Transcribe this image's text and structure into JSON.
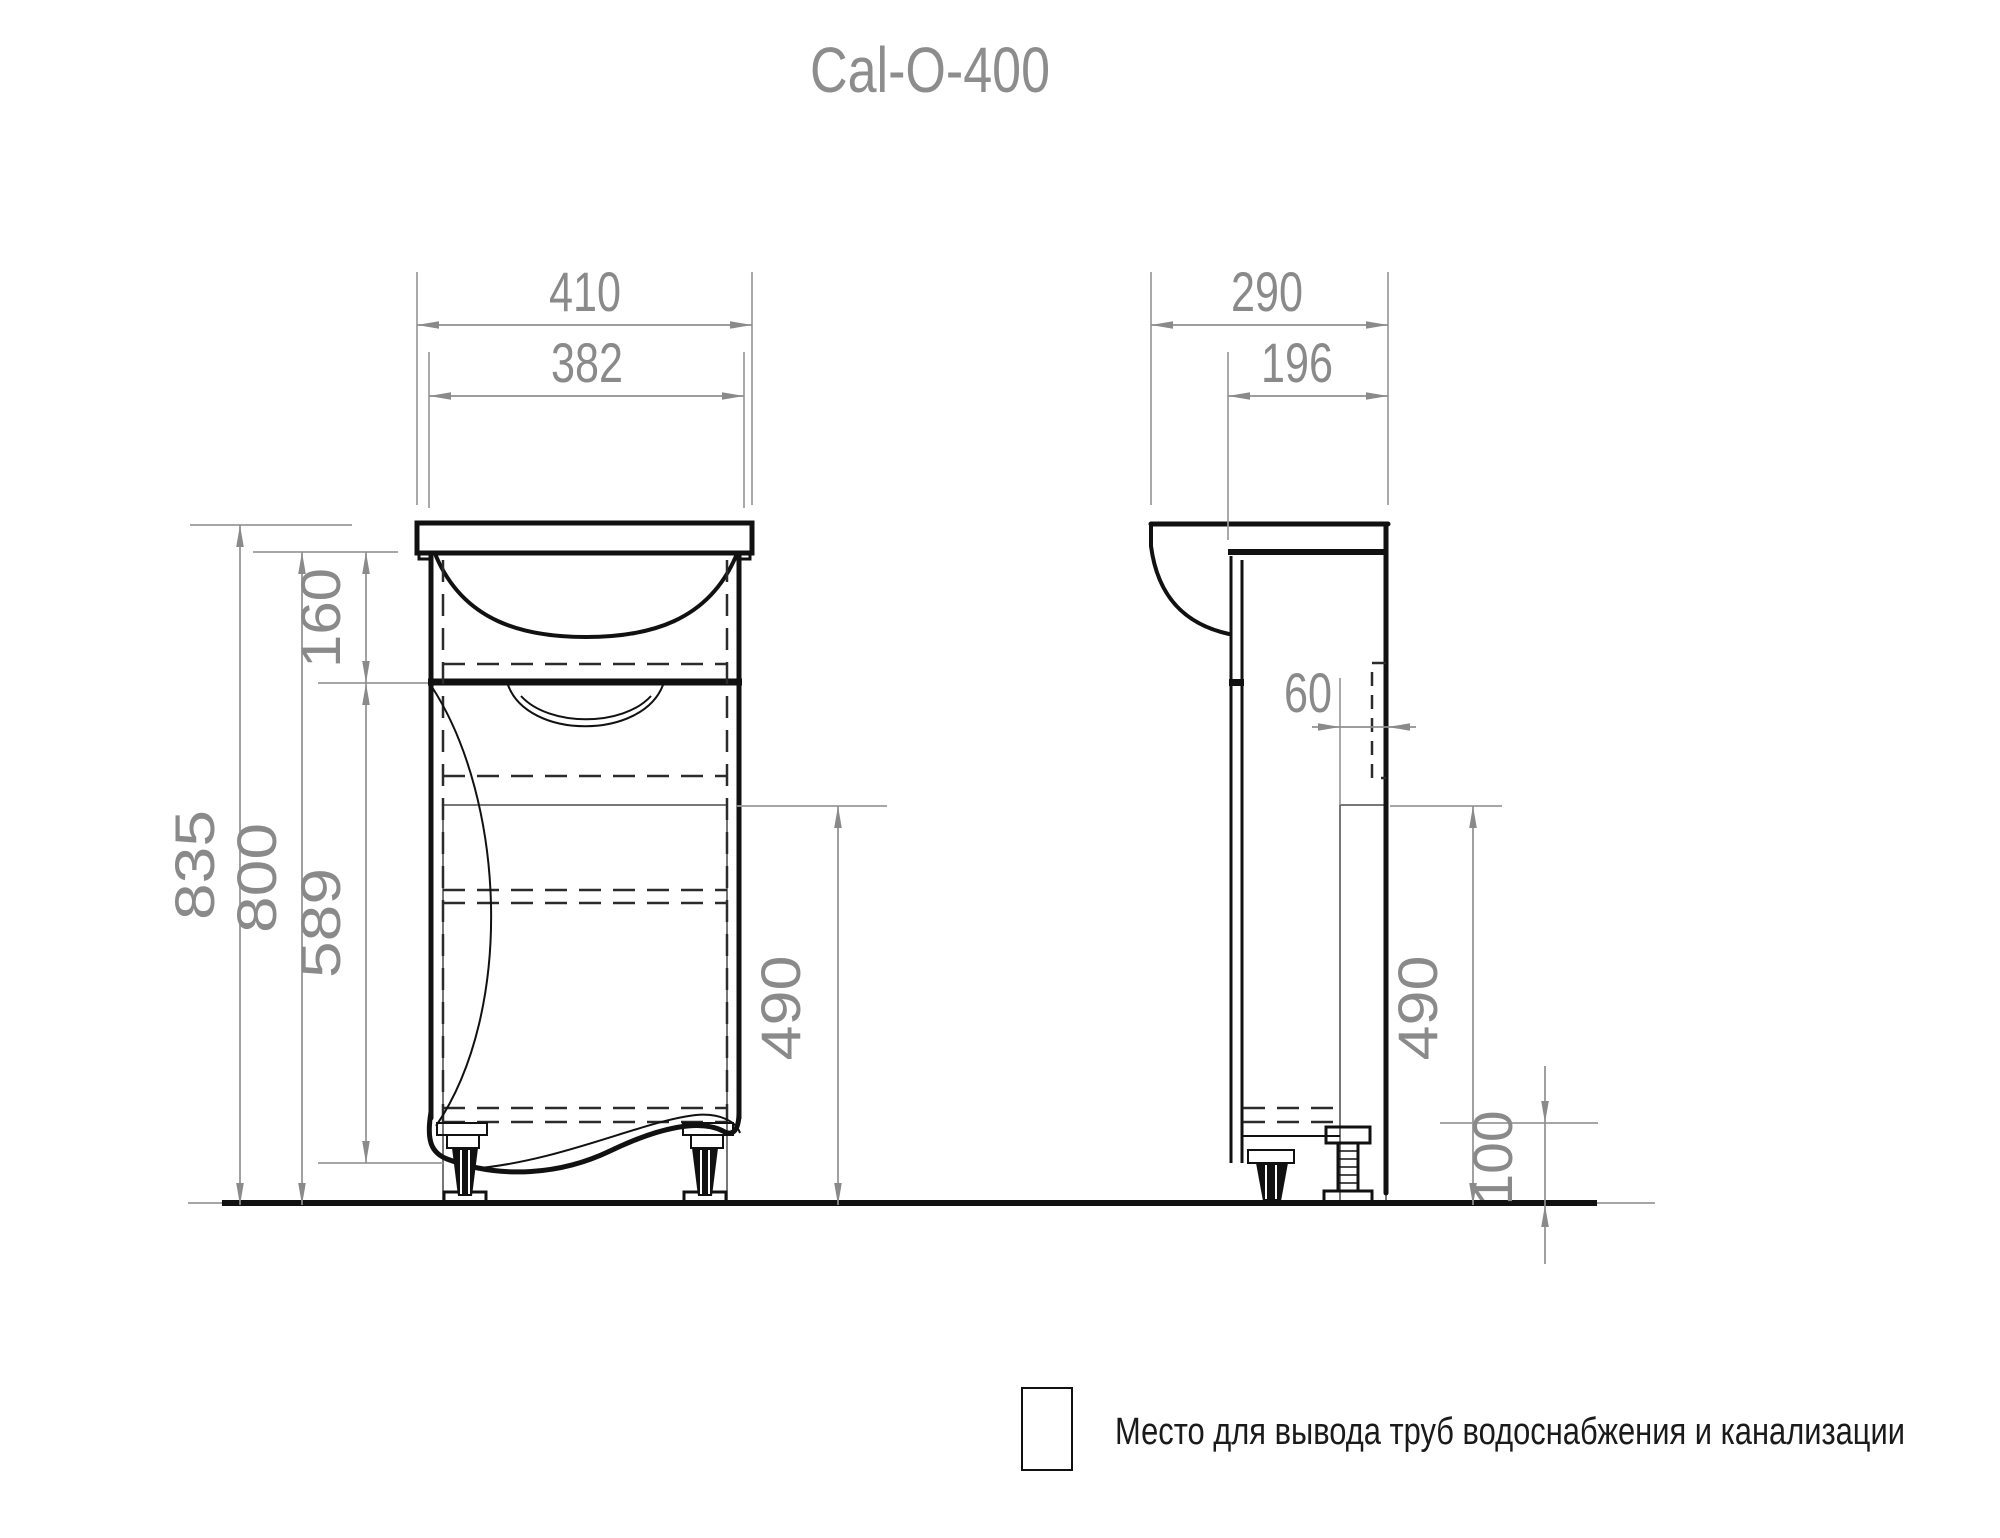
{
  "title": "Cal-O-400",
  "front_view": {
    "overall_width": "410",
    "basin_width": "382",
    "overall_height": "835",
    "cabinet_height": "800",
    "top_section_height": "160",
    "door_height": "589",
    "pipe_zone_height": "490"
  },
  "side_view": {
    "overall_depth": "290",
    "cabinet_depth": "196",
    "pipe_zone_depth": "60",
    "pipe_zone_height": "490",
    "plinth_height": "100"
  },
  "legend": {
    "swatch": "diagonal-hatch",
    "text": "Место для вывода труб водоснабжения и канализации"
  },
  "colors": {
    "line": "#111111",
    "dimension": "#8a8a8a",
    "background": "#ffffff"
  }
}
